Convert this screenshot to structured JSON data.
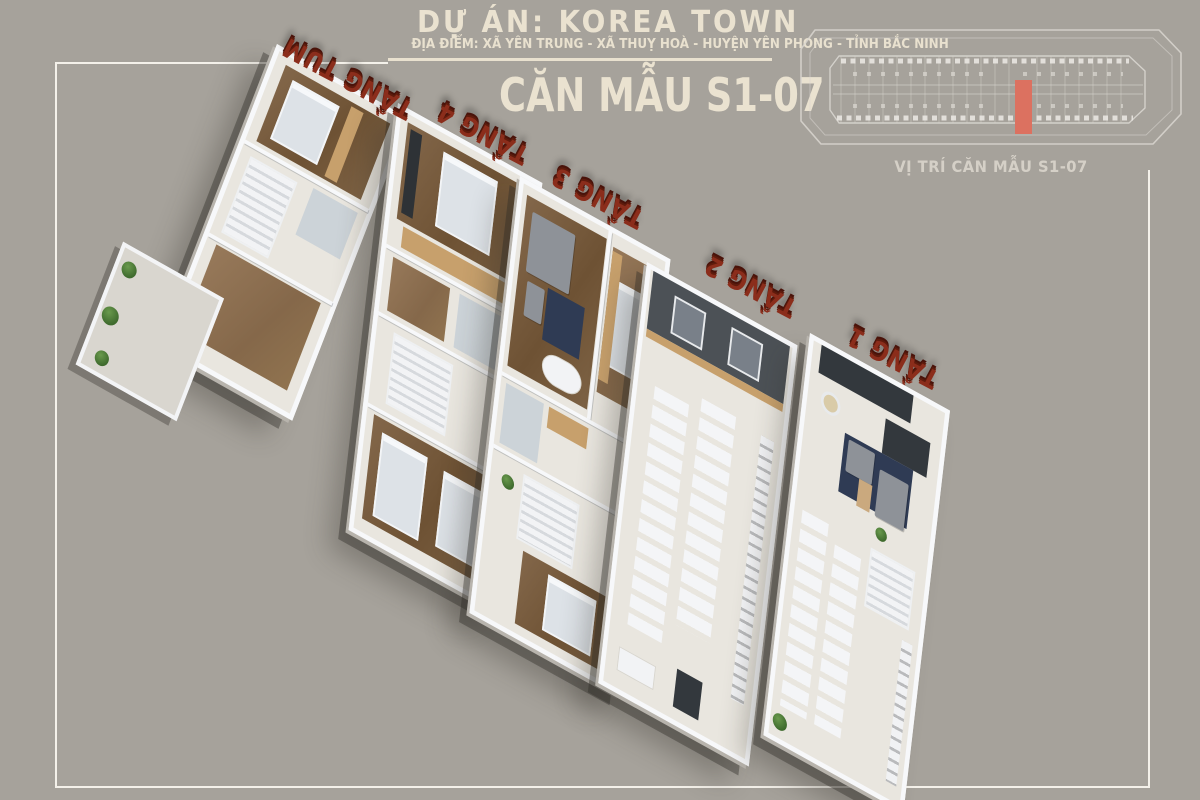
{
  "page": {
    "background_color": "#a6a29b",
    "frame_color": "#f4f1ea"
  },
  "header": {
    "project_title": "DỰ ÁN: KOREA TOWN",
    "location_line": "ĐỊA ĐIỂM: XÃ YÊN TRUNG - XÃ THUỴ HOÀ - HUYỆN YÊN PHONG - TỈNH BẮC NINH",
    "unit_title": "CĂN MẪU S1-07",
    "text_color": "#eae2d0"
  },
  "site_map": {
    "caption": "VỊ TRÍ CĂN MẪU S1-07",
    "line_color": "#d9d6d0",
    "highlight_color": "#dc7160"
  },
  "floors": [
    {
      "id": "tang-tum",
      "label": "TẦNG TUM"
    },
    {
      "id": "tang-4",
      "label": "TẦNG 4"
    },
    {
      "id": "tang-3",
      "label": "TẦNG 3"
    },
    {
      "id": "tang-2",
      "label": "TẦNG 2"
    },
    {
      "id": "tang-1",
      "label": "TẦNG 1"
    }
  ],
  "floor_label_color": "#8b2d1b"
}
